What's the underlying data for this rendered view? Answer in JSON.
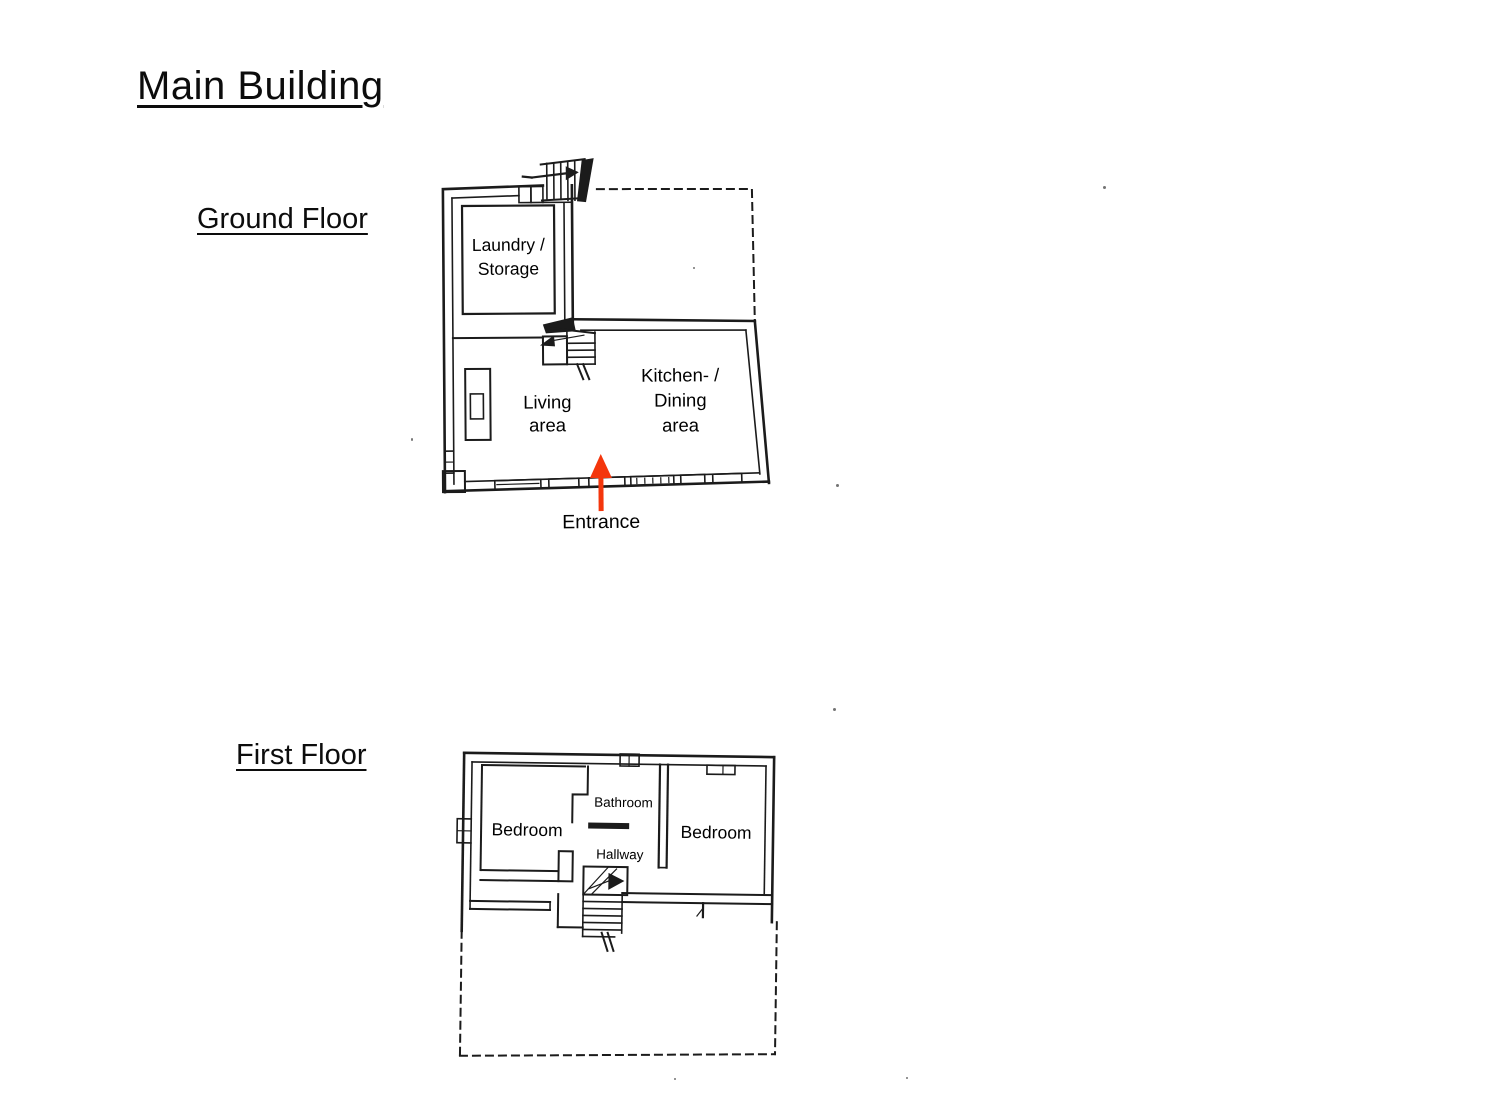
{
  "title": "Main Building",
  "ground_floor": {
    "label": "Ground Floor",
    "rooms": {
      "laundry_line1": "Laundry /",
      "laundry_line2": "Storage",
      "living_line1": "Living",
      "living_line2": "area",
      "kitchen_line1": "Kitchen- /",
      "kitchen_line2": "Dining",
      "kitchen_line3": "area"
    },
    "entrance_label": "Entrance"
  },
  "first_floor": {
    "label": "First Floor",
    "rooms": {
      "bedroom_left": "Bedroom",
      "bathroom": "Bathroom",
      "bedroom_right": "Bedroom",
      "hallway": "Hallway"
    }
  },
  "colors": {
    "line": "#1b1b1b",
    "text": "#000000",
    "entrance_arrow": "#f4360c",
    "background": "#ffffff"
  }
}
